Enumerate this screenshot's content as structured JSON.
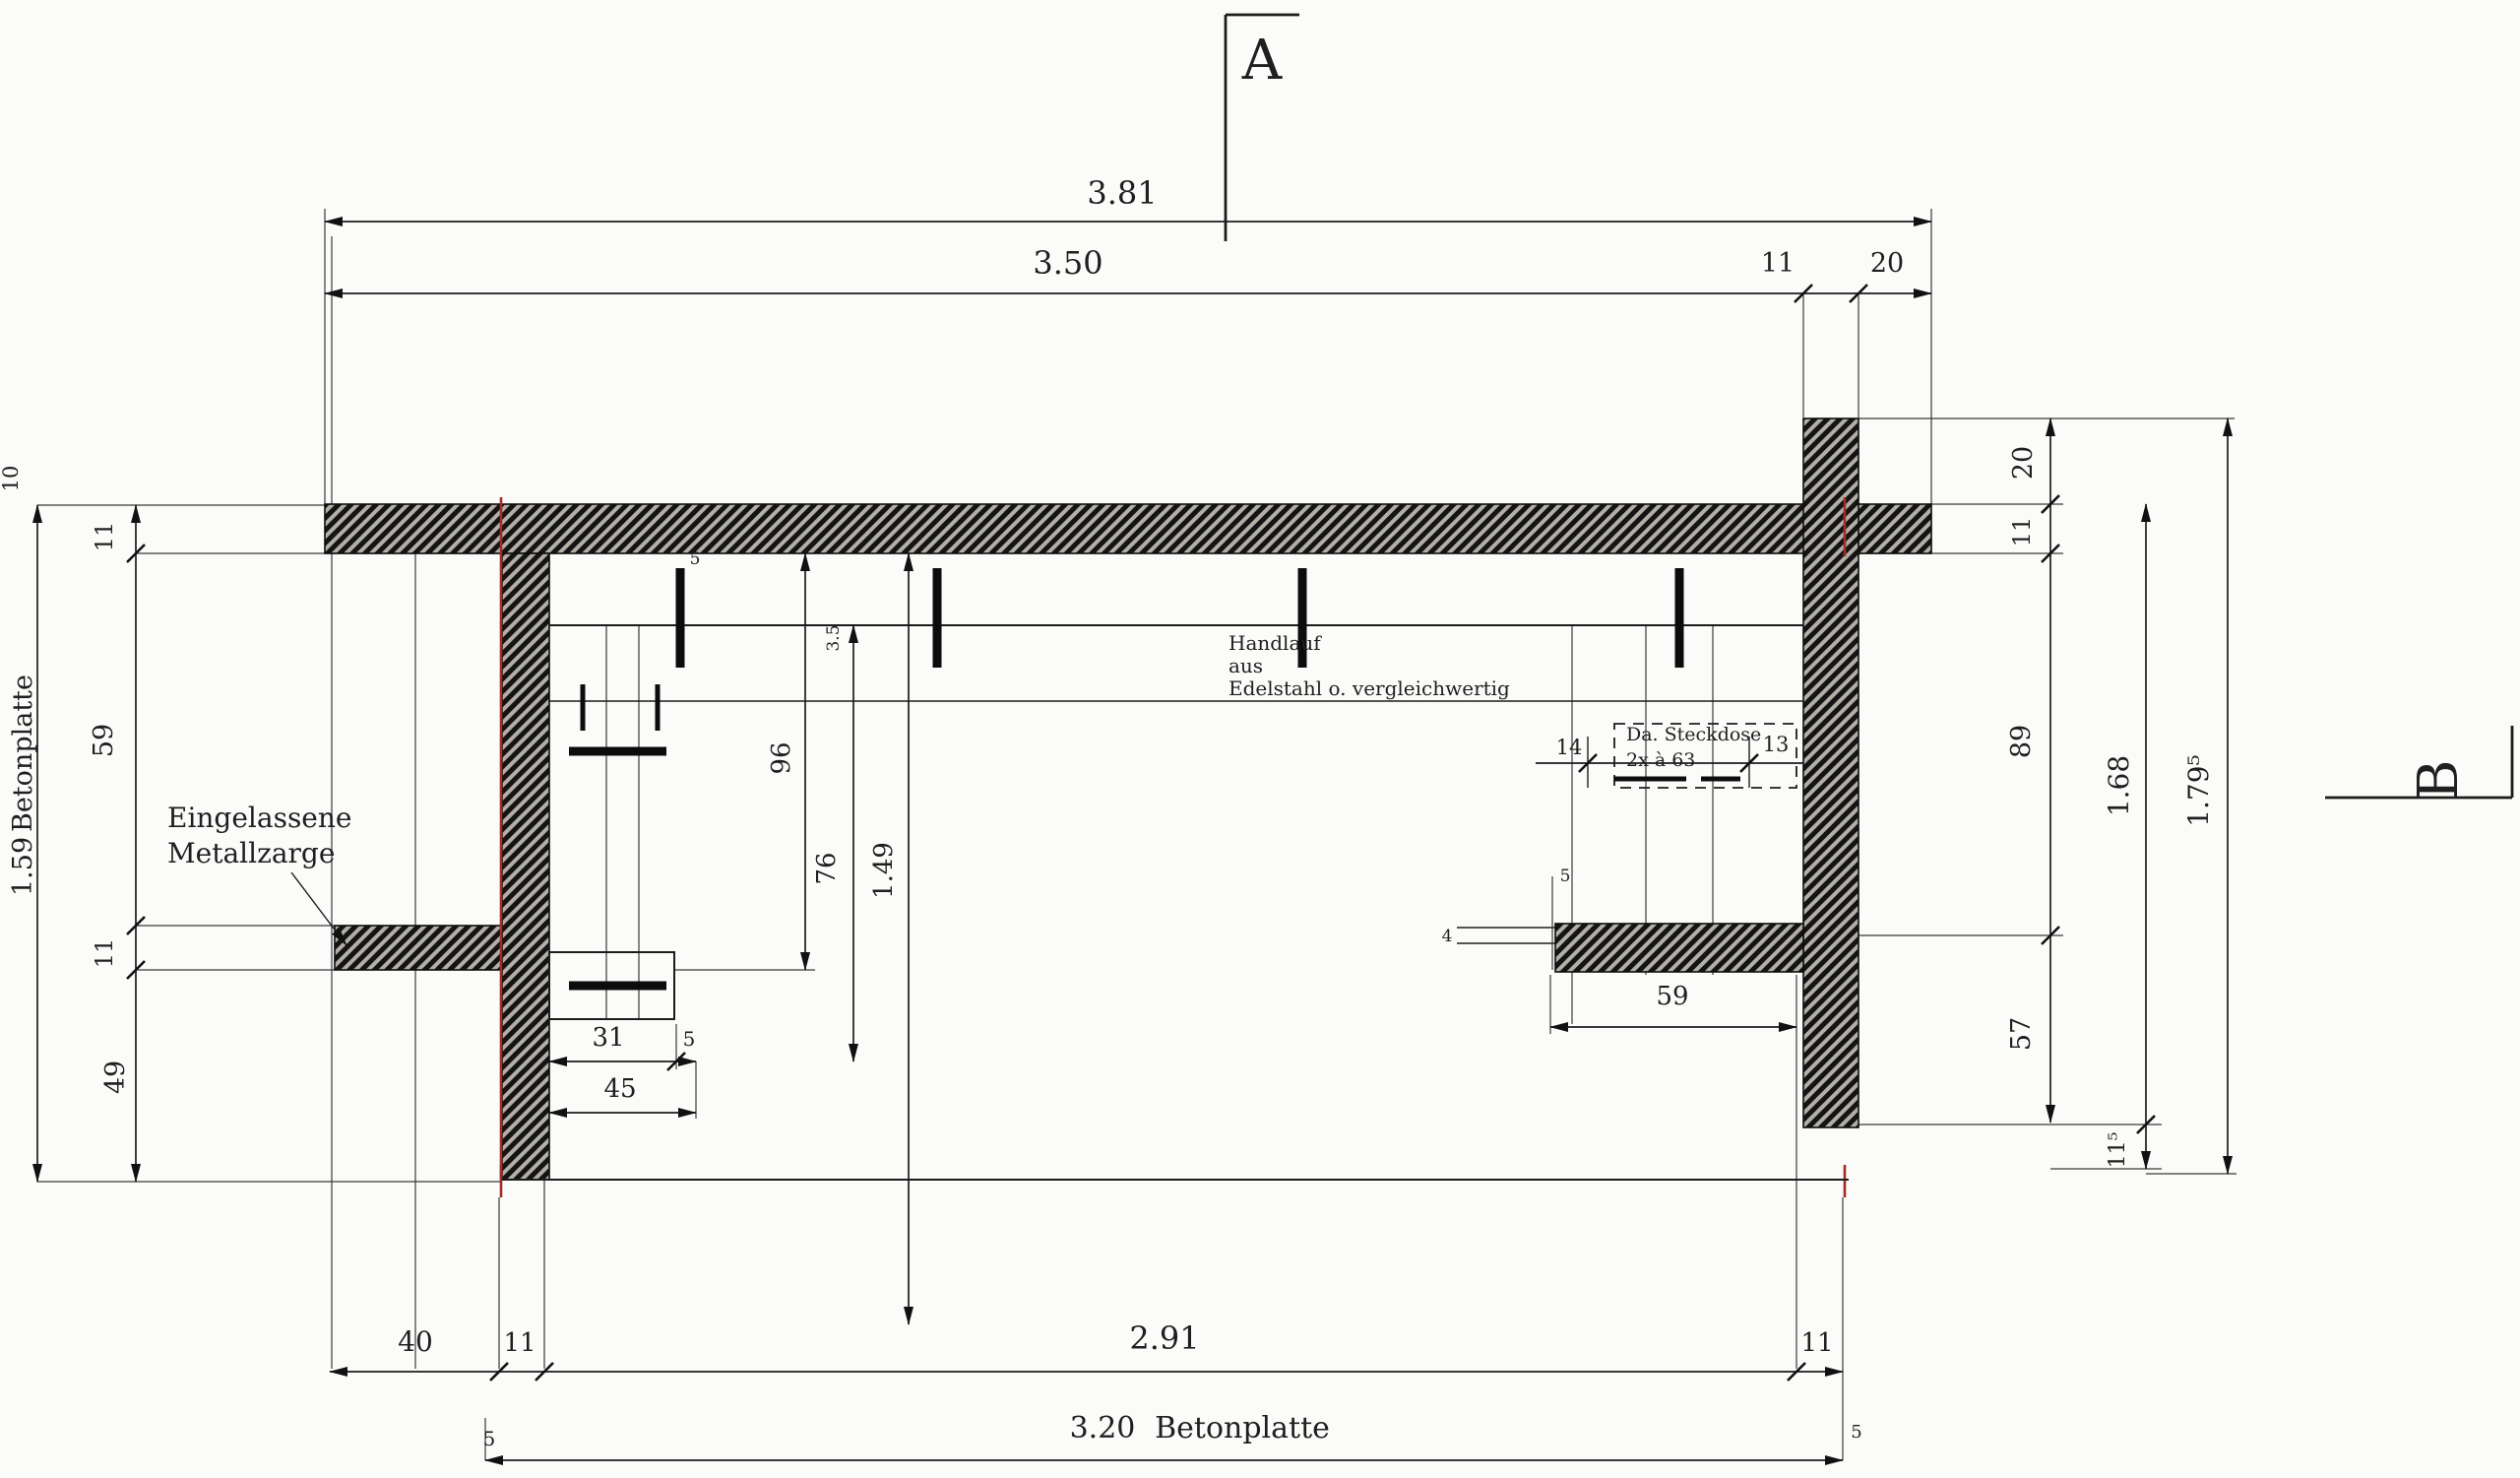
{
  "colors": {
    "accent_red": "#a32b27",
    "line": "#1c1c1c",
    "paper": "#fbfbf9"
  },
  "sections": {
    "a": "A",
    "b": "B"
  },
  "dims_top": {
    "total": "3.81",
    "inner": "3.50",
    "wall": "11",
    "edge": "20"
  },
  "dims_left": {
    "offset": "10",
    "total_value": "1.59",
    "total_word": "Betonplatte",
    "seg1": "11",
    "seg2": "59",
    "seg3": "11",
    "seg4": "49"
  },
  "dims_right": {
    "seg_top": "20",
    "seg_wall": "11",
    "seg_a": "89",
    "seg_b": "57",
    "seg_c": "11⁵",
    "inner_total": "1.68",
    "outer_total": "1.79⁵"
  },
  "dims_bottom": {
    "seg1": "40",
    "seg2": "11",
    "span": "2.91",
    "seg3": "11",
    "total_value": "3.20",
    "total_word": "Betonplatte",
    "sup_left": "5",
    "sup_right": "5"
  },
  "door_left": {
    "w1": "31",
    "w2": "5",
    "w3": "45",
    "h1": "96",
    "h2": "76",
    "h3": "1.49",
    "t1": "3.5",
    "t2": "5"
  },
  "door_right": {
    "span": "59",
    "t1": "4",
    "t2": "5",
    "gap_left": "14",
    "gap_right": "13"
  },
  "socket": {
    "line1": "Da. Steckdose",
    "line2": "2x à 63"
  },
  "notes": {
    "frame_line1": "Eingelassene",
    "frame_line2": "Metallzarge",
    "rail_line1": "Handlauf",
    "rail_line2": "aus",
    "rail_line3": "Edelstahl o. vergleichwertig"
  }
}
